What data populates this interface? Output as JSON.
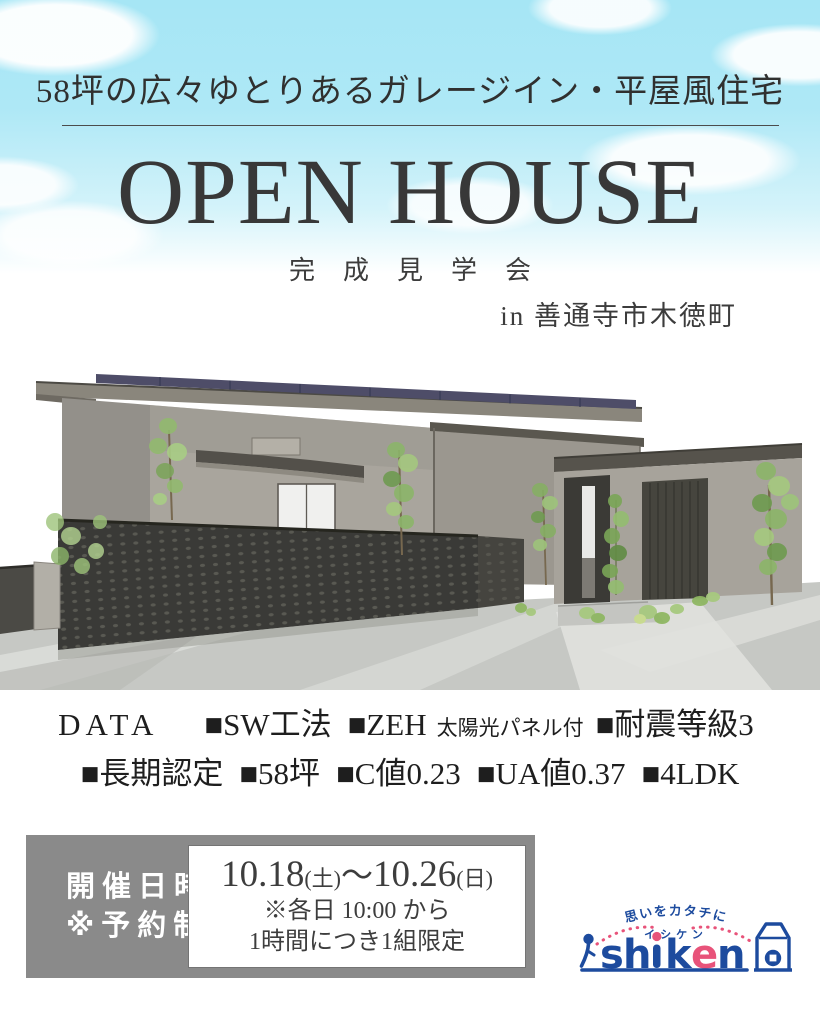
{
  "header": {
    "headline": "58坪の広々ゆとりあるガレージイン・平屋風住宅",
    "title": "OPEN HOUSE",
    "subtitle": "完成見学会",
    "location": "in 善通寺市木徳町"
  },
  "illustration": {
    "description": "平屋風住宅の外観パース（グレー外壁・片流れ屋根に太陽光パネル・黒い格子フェンス・植栽）"
  },
  "specs": {
    "label": "DATA",
    "line1": [
      "■SW工法",
      "■ZEH",
      "■耐震等級3"
    ],
    "zeh_note": "太陽光パネル付",
    "line2": [
      "■長期認定",
      "■58坪",
      "■C値0.23",
      "■UA値0.37",
      "■4LDK"
    ]
  },
  "schedule": {
    "label_line1": "開催日時",
    "label_line2": "※予約制",
    "date_start": "10.18",
    "date_start_day": "(土)",
    "tilde": "～",
    "date_end": "10.26",
    "date_end_day": "(日)",
    "note1": "※各日 10:00 から",
    "note2": "1時間につき1組限定"
  },
  "logo": {
    "tagline": "思いをカタチに",
    "katakana": "イシケン",
    "letters": {
      "s": "s",
      "h": "h",
      "k": "k",
      "e": "e",
      "n": "n"
    },
    "colors": {
      "blue": "#1d4b9e",
      "red": "#e8537a"
    }
  },
  "colors": {
    "sky": "#a6e6f5",
    "text_dark": "#3a3a3a",
    "box_gray": "#8a8a8a",
    "solar_panel": "#4e4d68",
    "fence_dark": "#3a3a37"
  }
}
